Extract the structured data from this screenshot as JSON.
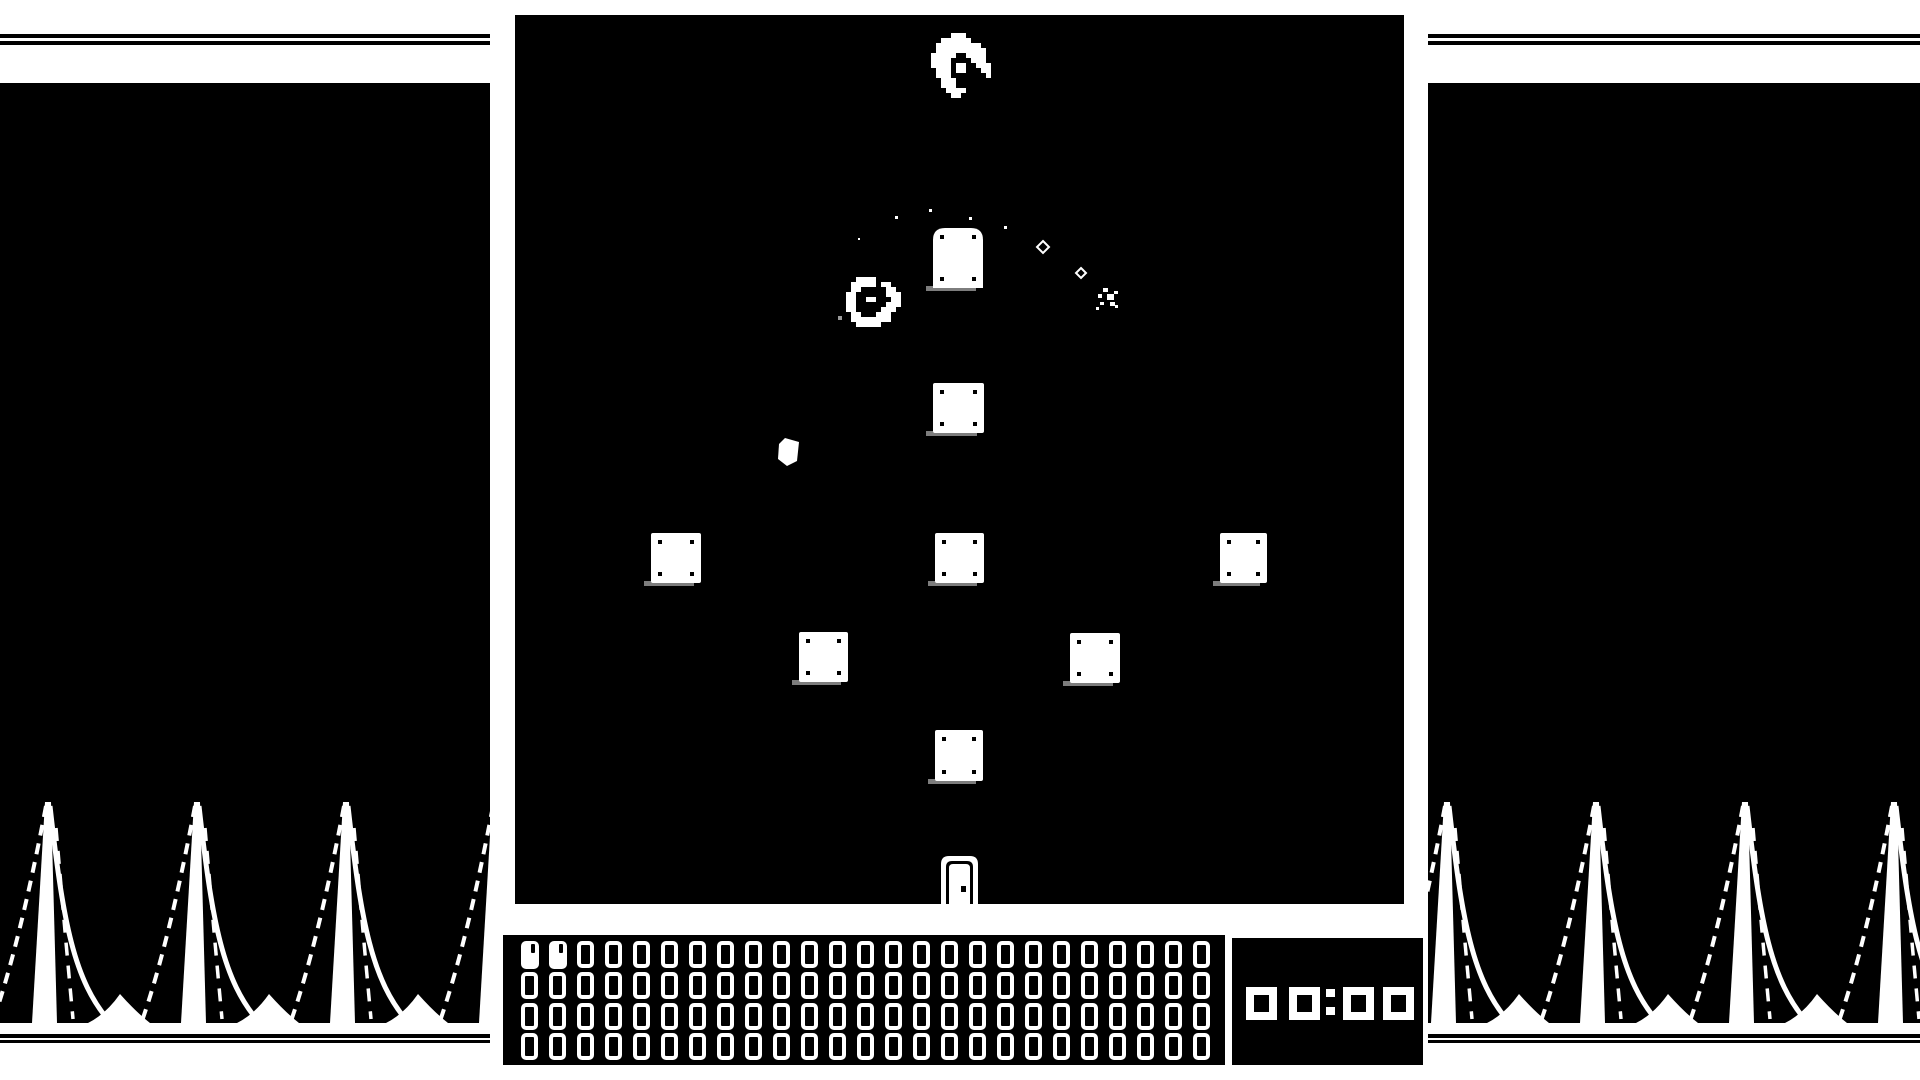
{
  "app": {
    "title": "1-bit action game screen"
  },
  "colors": {
    "bg": "#ffffff",
    "ink": "#000000",
    "white": "#ffffff",
    "shadow": "#7d7d7d",
    "dim_dot": "#9a9a9a"
  },
  "layout": {
    "stripes_top": [
      {
        "y": 34,
        "h": 3.5
      },
      {
        "y": 41,
        "h": 4
      }
    ],
    "stripes_bottom": [
      {
        "y": 1034,
        "h": 3.5
      },
      {
        "y": 1039.5,
        "h": 3.5
      }
    ],
    "panel_left": {
      "x": 0,
      "y": 83,
      "w": 490,
      "h": 940
    },
    "panel_right": {
      "x": 1428,
      "y": 83,
      "w": 492,
      "h": 940
    },
    "game": {
      "x": 515,
      "y": 15,
      "w": 889,
      "h": 889
    }
  },
  "spikes": {
    "tip_y": 719,
    "ground_y": 940,
    "pitch": 149,
    "left_centers": [
      48,
      197,
      346,
      495
    ],
    "right_centers": [
      19,
      168,
      317,
      466
    ]
  },
  "game_objects": {
    "blocks": [
      {
        "name": "tombstone-block",
        "x": 418,
        "y": 213,
        "w": 50,
        "h": 60,
        "arched": true
      },
      {
        "name": "block",
        "x": 418,
        "y": 368,
        "w": 51,
        "h": 50
      },
      {
        "name": "block",
        "x": 136,
        "y": 518,
        "w": 50,
        "h": 50
      },
      {
        "name": "block",
        "x": 420,
        "y": 518,
        "w": 49,
        "h": 50
      },
      {
        "name": "block",
        "x": 705,
        "y": 518,
        "w": 47,
        "h": 50
      },
      {
        "name": "block",
        "x": 284,
        "y": 617,
        "w": 49,
        "h": 50
      },
      {
        "name": "block",
        "x": 555,
        "y": 618,
        "w": 50,
        "h": 50
      },
      {
        "name": "block",
        "x": 420,
        "y": 715,
        "w": 48,
        "h": 51
      }
    ],
    "rivet": {
      "inset": 7,
      "size": 4
    },
    "door": {
      "x": 426,
      "y": 841,
      "w": 37,
      "h": 48,
      "knob": [
        446,
        871,
        5,
        6
      ]
    },
    "debris_points": "270,423 284,427 282,446 272,451 263,444 264,429",
    "dots": [
      [
        343,
        223,
        2
      ],
      [
        380,
        201,
        3
      ],
      [
        414,
        194,
        3
      ],
      [
        454,
        202,
        3
      ],
      [
        489,
        211,
        3
      ]
    ],
    "gray_dot": [
      323,
      301,
      4
    ],
    "diamond_sparkles": [
      {
        "cx": 528,
        "cy": 232,
        "r": 6
      },
      {
        "cx": 566,
        "cy": 258,
        "r": 5
      }
    ],
    "twinkle_rects": [
      [
        588,
        273,
        5,
        4
      ],
      [
        583,
        279,
        4,
        4
      ],
      [
        592,
        279,
        7,
        6
      ],
      [
        599,
        276,
        4,
        3
      ],
      [
        585,
        287,
        4,
        3
      ],
      [
        595,
        287,
        5,
        4
      ],
      [
        581,
        292,
        3,
        3
      ],
      [
        600,
        290,
        3,
        3
      ]
    ],
    "creature": {
      "x": 416,
      "y": 18,
      "cell": 5,
      "rows": [
        "....XXX.....",
        "..XXXXXX....",
        ".XXXXXXXXX..",
        ".XXXXXXXXXX.",
        "XXXXX..XXXX.",
        "XXXX....XXX.",
        "XXXX.XX..XXX",
        ".XXX.XX...XX",
        ".XXX.......X",
        "..XXX.......",
        "..XXX.......",
        "...XXXX.....",
        "....XX......"
      ]
    },
    "player": {
      "x": 331,
      "y": 262,
      "cell": 5,
      "rows": [
        "..XXXX.....",
        ".XXXXX.XX..",
        ".XX.....XX.",
        "XX......XXX",
        "XX..XX...XX",
        "XX......XXX",
        "XX.....XXX.",
        ".XX...XXX..",
        ".XXXXXXXX..",
        "..XXXXX...."
      ]
    }
  },
  "counter": {
    "x": 503,
    "y": 935,
    "w": 722,
    "h": 130,
    "cols": 25,
    "rows": 4,
    "total": 100,
    "filled": 2,
    "cell": {
      "pad_x": 18,
      "pad_y": 6,
      "pitch_x": 28,
      "pitch_y": 30.8,
      "w": 17,
      "h": 27
    }
  },
  "timer": {
    "x": 1232,
    "y": 938,
    "w": 191,
    "h": 127,
    "value": "00:00",
    "digit": {
      "y": 49,
      "w": 31,
      "h": 33,
      "xs": [
        14,
        57,
        94,
        111,
        151
      ]
    },
    "colon": {
      "w": 9,
      "h": 8,
      "dy": [
        2,
        20
      ]
    }
  }
}
